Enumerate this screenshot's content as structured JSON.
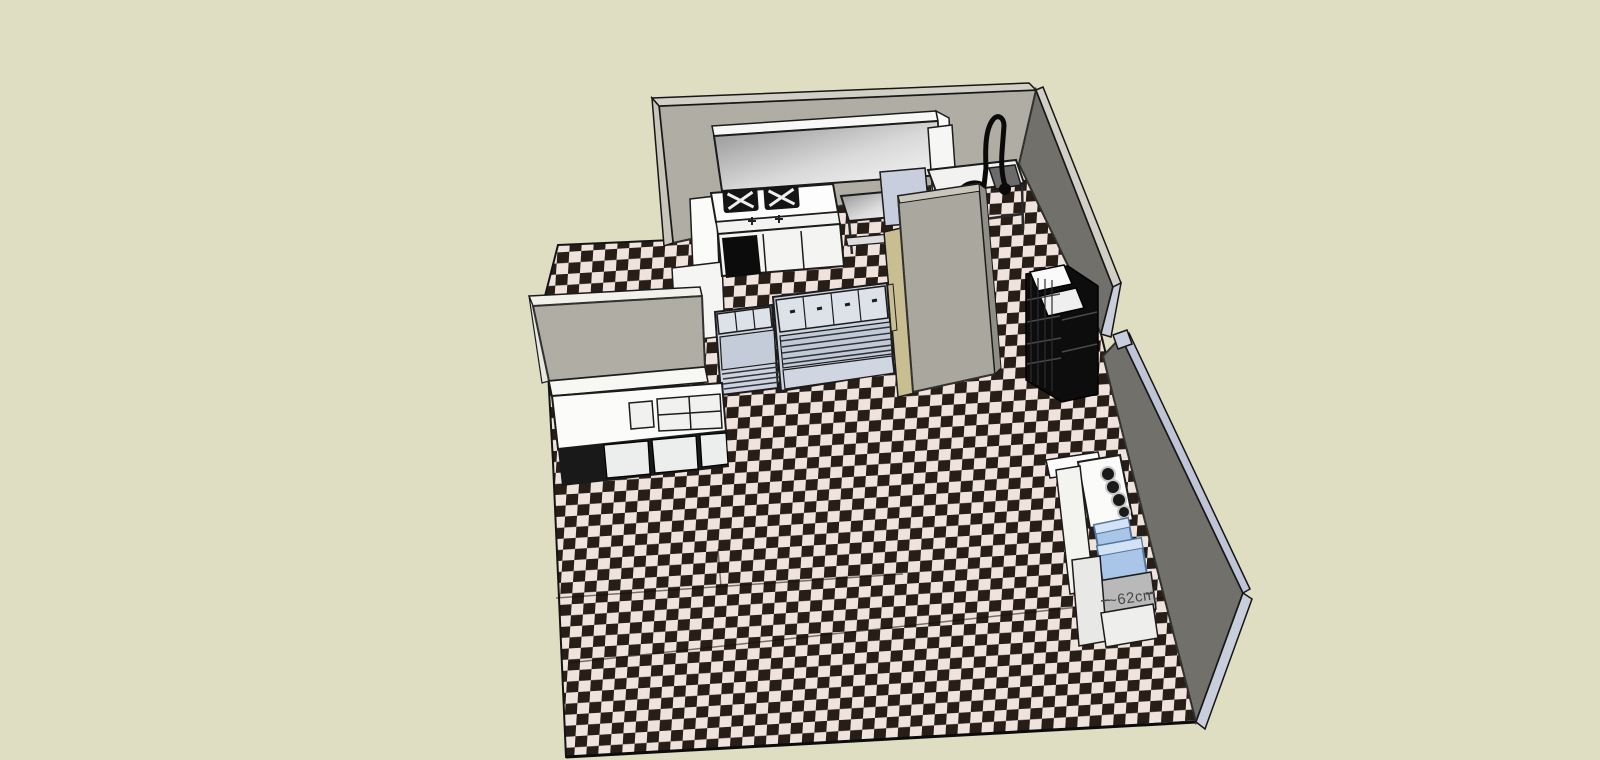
{
  "viewport": {
    "width": 1600,
    "height": 760,
    "annotation": {
      "dimension_label": "~62cm",
      "color": "#474747"
    }
  },
  "colors": {
    "background": "#dfddc2",
    "tile_dark": "#271e18",
    "tile_light": "#f0e3dd",
    "wall_face_light": "#b4b1a7",
    "wall_face_dark": "#6e6d68",
    "wall_top_edge": "#d2d0c6",
    "wall_cut_edge": "#c9cedd",
    "partition_face": "#aeaba1",
    "partition_tan_edge": "#c9bd92",
    "equipment_white": "#fbfbfa",
    "equipment_blue_gray": "#ccd3df",
    "bin_blue": "#a9c6e8",
    "rack_black": "#0d0d0d",
    "faucet_black": "#0a0a0a"
  },
  "scene": {
    "objects": [
      "checkered-floor",
      "back-wall",
      "right-wall-upper",
      "right-wall-lower",
      "partition-wall",
      "half-wall",
      "service-counter",
      "range-hood",
      "gas-range",
      "oven-cabinets",
      "work-table",
      "sink-table",
      "pre-rinse-faucet",
      "storage-rack",
      "prep-counter-small",
      "prep-counter-large",
      "coffee-station",
      "ingredient-bins",
      "dimension-annotation"
    ]
  }
}
